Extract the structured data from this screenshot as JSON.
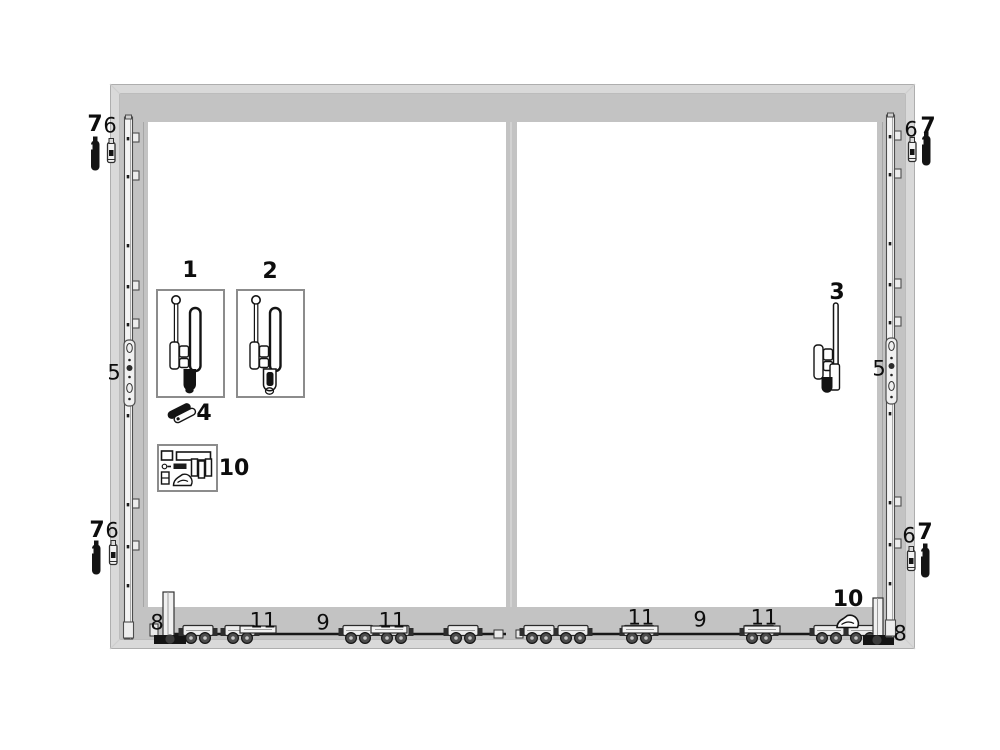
{
  "diagram": {
    "kind": "sliding-door-hardware-parts-diagram",
    "frame_panels": 2
  },
  "colors": {
    "frame_band": "#d9d9d9",
    "frame_face": "#c3c3c3",
    "frame_edge": "#aeaeae",
    "opening": "#ffffff",
    "hardware_dark": "#141414",
    "hardware_light": "#f2f2f2",
    "label_text": "#0d0d0d",
    "box_border": "#8c8c8c"
  },
  "labels": [
    {
      "text": "7",
      "x": 95,
      "y": 125,
      "bold": true
    },
    {
      "text": "6",
      "x": 110,
      "y": 126,
      "bold": false
    },
    {
      "text": "6",
      "x": 911,
      "y": 130,
      "bold": false
    },
    {
      "text": "7",
      "x": 928,
      "y": 127,
      "bold": true
    },
    {
      "text": "5",
      "x": 114,
      "y": 373,
      "bold": false
    },
    {
      "text": "5",
      "x": 879,
      "y": 369,
      "bold": false
    },
    {
      "text": "1",
      "x": 190,
      "y": 271,
      "bold": true
    },
    {
      "text": "2",
      "x": 270,
      "y": 272,
      "bold": true
    },
    {
      "text": "3",
      "x": 837,
      "y": 293,
      "bold": true
    },
    {
      "text": "4",
      "x": 204,
      "y": 414,
      "bold": true
    },
    {
      "text": "10",
      "x": 234,
      "y": 469,
      "bold": true
    },
    {
      "text": "7",
      "x": 97,
      "y": 531,
      "bold": true
    },
    {
      "text": "6",
      "x": 112,
      "y": 531,
      "bold": false
    },
    {
      "text": "6",
      "x": 909,
      "y": 536,
      "bold": false
    },
    {
      "text": "7",
      "x": 925,
      "y": 533,
      "bold": true
    },
    {
      "text": "8",
      "x": 157,
      "y": 623,
      "bold": false
    },
    {
      "text": "11",
      "x": 263,
      "y": 621,
      "bold": false
    },
    {
      "text": "9",
      "x": 323,
      "y": 623,
      "bold": false
    },
    {
      "text": "11",
      "x": 392,
      "y": 621,
      "bold": false
    },
    {
      "text": "11",
      "x": 641,
      "y": 618,
      "bold": false
    },
    {
      "text": "9",
      "x": 700,
      "y": 620,
      "bold": false
    },
    {
      "text": "11",
      "x": 764,
      "y": 618,
      "bold": false
    },
    {
      "text": "10",
      "x": 848,
      "y": 600,
      "bold": true
    },
    {
      "text": "8",
      "x": 900,
      "y": 634,
      "bold": false
    }
  ],
  "parts": [
    {
      "label": "1",
      "name": "handle-gear-set-a",
      "boxed": true
    },
    {
      "label": "2",
      "name": "handle-gear-set-b",
      "boxed": true
    },
    {
      "label": "3",
      "name": "pull-handle",
      "boxed": false
    },
    {
      "label": "4",
      "name": "locking-cam",
      "boxed": false
    },
    {
      "label": "5",
      "name": "espagnolette-lock-rail",
      "boxed": false
    },
    {
      "label": "6",
      "name": "keep-latch",
      "boxed": false
    },
    {
      "label": "7",
      "name": "locking-pin-cap",
      "boxed": false
    },
    {
      "label": "8",
      "name": "corner-end-guide",
      "boxed": false
    },
    {
      "label": "9",
      "name": "connecting-bar",
      "boxed": false
    },
    {
      "label": "10",
      "name": "accessory-fitting-kit",
      "boxed": true
    },
    {
      "label": "11",
      "name": "roller-carriage-unit",
      "boxed": false
    }
  ]
}
